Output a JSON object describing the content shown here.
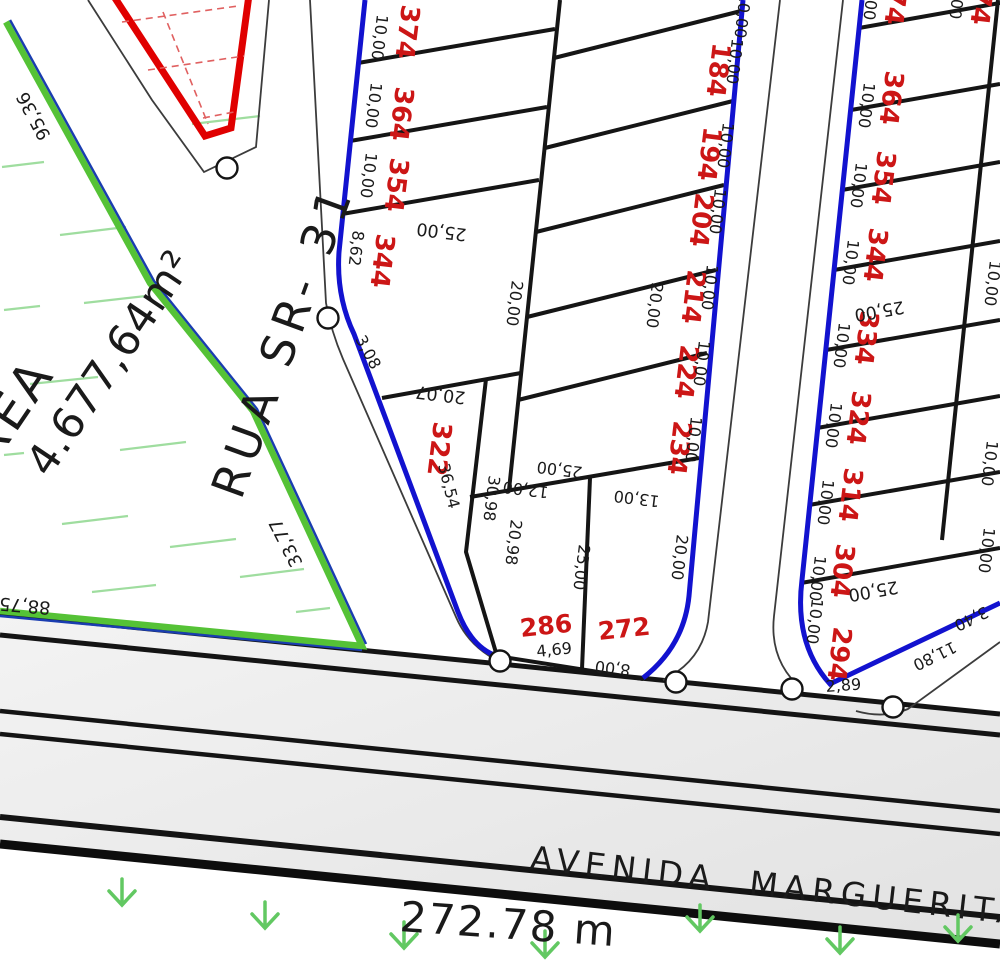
{
  "streets": {
    "rua_sr31": "RUA SR- 31",
    "avenida": "AVENIDA  MARGUERITA",
    "avenida_extent": "272.78 m"
  },
  "green_area": {
    "label": "ÁREA",
    "value": "4.677,64m²"
  },
  "perimeter_dims": {
    "upper_left": "95,36",
    "lower_left": "33,77",
    "bottom_left": "88,75"
  },
  "block1_street_column": {
    "numbers": [
      "374",
      "364",
      "354",
      "344",
      "322",
      "286"
    ],
    "frontage_dims": [
      "10,00",
      "10,00",
      "10,00",
      "8,62",
      "36,54",
      "4,69"
    ],
    "depth_dim": "25,00",
    "bend_dim": "3,08",
    "row_dim": "20,07",
    "side_dims": [
      "30,98",
      "20,98"
    ],
    "col_dim": "20,00",
    "south_dims": [
      "12,00",
      "25,00",
      "13,00",
      "25,00"
    ]
  },
  "block1_inner_column": {
    "numbers": [
      "184",
      "194",
      "204",
      "214",
      "224",
      "234",
      "272"
    ],
    "frontage_dims": [
      "10,00",
      "10,00",
      "10,00",
      "10,00",
      "10,00",
      "10,00"
    ],
    "top_dim": "10,00",
    "depth_dims": [
      "20,00",
      "20,00"
    ],
    "bottom_dim": "8,00"
  },
  "block2_column": {
    "numbers": [
      "374",
      "364",
      "354",
      "344",
      "334",
      "324",
      "314",
      "304",
      "294"
    ],
    "frontage_dims": [
      "10,00",
      "10,00",
      "10,00",
      "10,00",
      "10,00",
      "10,00",
      "10,00",
      "10,00",
      "10,00"
    ],
    "depth_dims": [
      "25,00",
      "25,00"
    ],
    "east_dims": [
      "10,00",
      "10,00",
      "10,00"
    ],
    "corner_dims": [
      "3,40",
      "11,80",
      "2,89"
    ]
  },
  "block2_east_column": {
    "number": "374",
    "frontage_dim": "10,00"
  },
  "colors": {
    "lot_number_red": "#cc1616",
    "boundary_blue": "#1212cf",
    "boundary_green": "#55c236",
    "hatch_green": "#9fdd9f",
    "grass_green": "#62c862",
    "road_gray": "#ebebeb",
    "wedge_red": "#e00000"
  }
}
